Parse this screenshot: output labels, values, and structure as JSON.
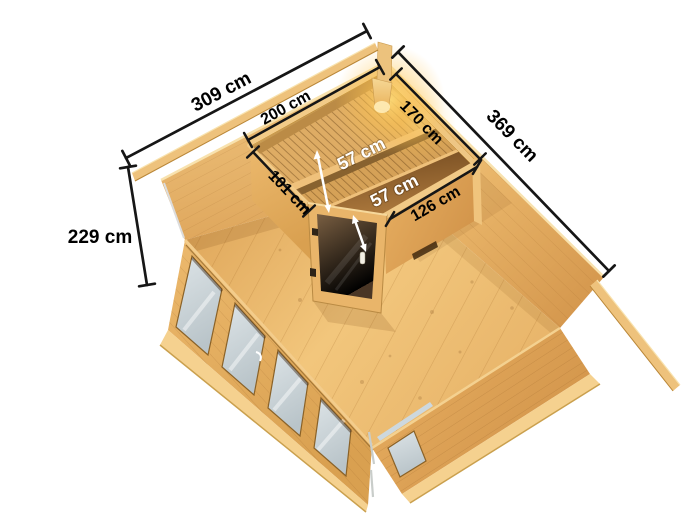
{
  "illustration": {
    "background_color": "#ffffff",
    "dimension_line_color": "#161616",
    "dimension_text_color": "#000000",
    "bench_label_color": "#ffffff",
    "wood_palette": {
      "wall_light": "#f4d08c",
      "wall_mid": "#e6b269",
      "wall_dark": "#d89c51",
      "floor": "#eebb70",
      "bench": "#d9a55c",
      "beam": "#eec27c",
      "door_glass": "#5d4730",
      "window_glass": "#ccd6da",
      "lamp_glow": "#ffd24e"
    },
    "dimensions": {
      "building_width": "309 cm",
      "building_depth": "369 cm",
      "building_height": "229 cm",
      "sauna_width": "200 cm",
      "sauna_depth": "170 cm",
      "sauna_left_side": "101 cm",
      "sauna_front_side": "126 cm",
      "bench_upper_depth": "57 cm",
      "bench_lower_depth": "57 cm"
    }
  }
}
